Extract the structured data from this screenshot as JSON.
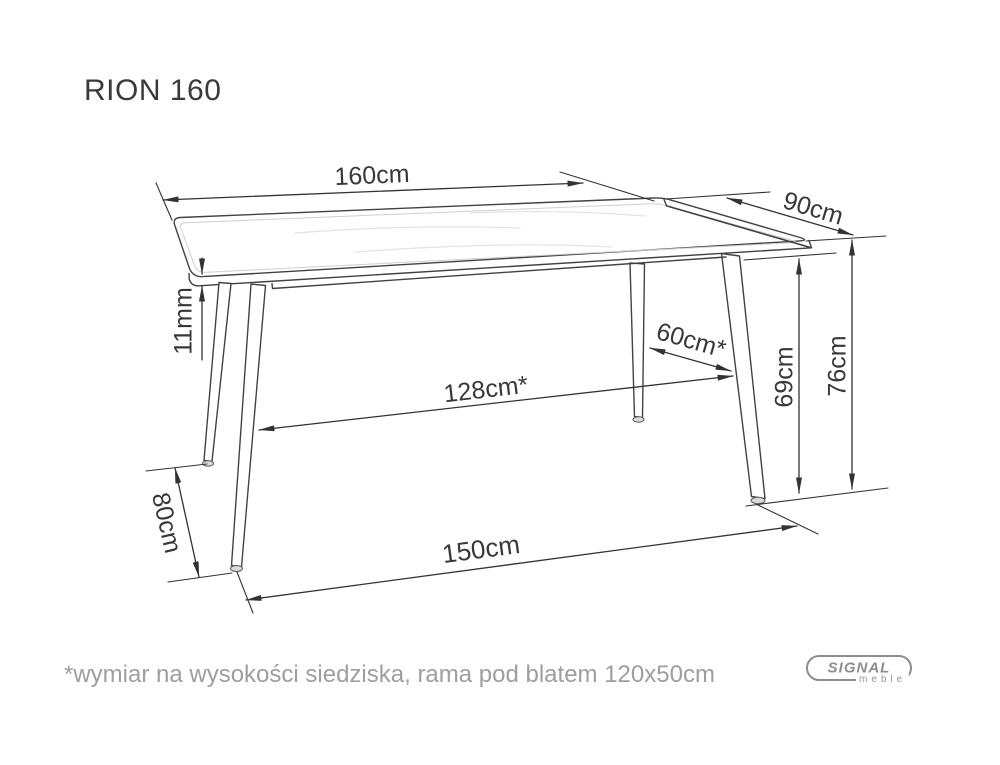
{
  "title": "RION 160",
  "drawing": {
    "subject": "dining-table-technical-drawing",
    "dimensions": {
      "top_length": "160cm",
      "top_width": "90cm",
      "height_total": "76cm",
      "height_under_frame": "69cm",
      "top_thickness": "11mm",
      "leg_spacing_depth": "60cm*",
      "leg_spacing_length": "128cm*",
      "feet_spacing_depth": "80cm",
      "feet_spacing_length": "150cm"
    }
  },
  "footnote": "*wymiar na wysokości siedziska, rama pod blatem 120x50cm",
  "logo": {
    "brand": "SIGNAL",
    "sub": "meble"
  },
  "colors": {
    "outline": "#424242",
    "dimension": "#333333",
    "text": "#383838",
    "muted_text": "#9e9e9e",
    "logo_gray": "#8d8d8d",
    "background": "#ffffff"
  }
}
